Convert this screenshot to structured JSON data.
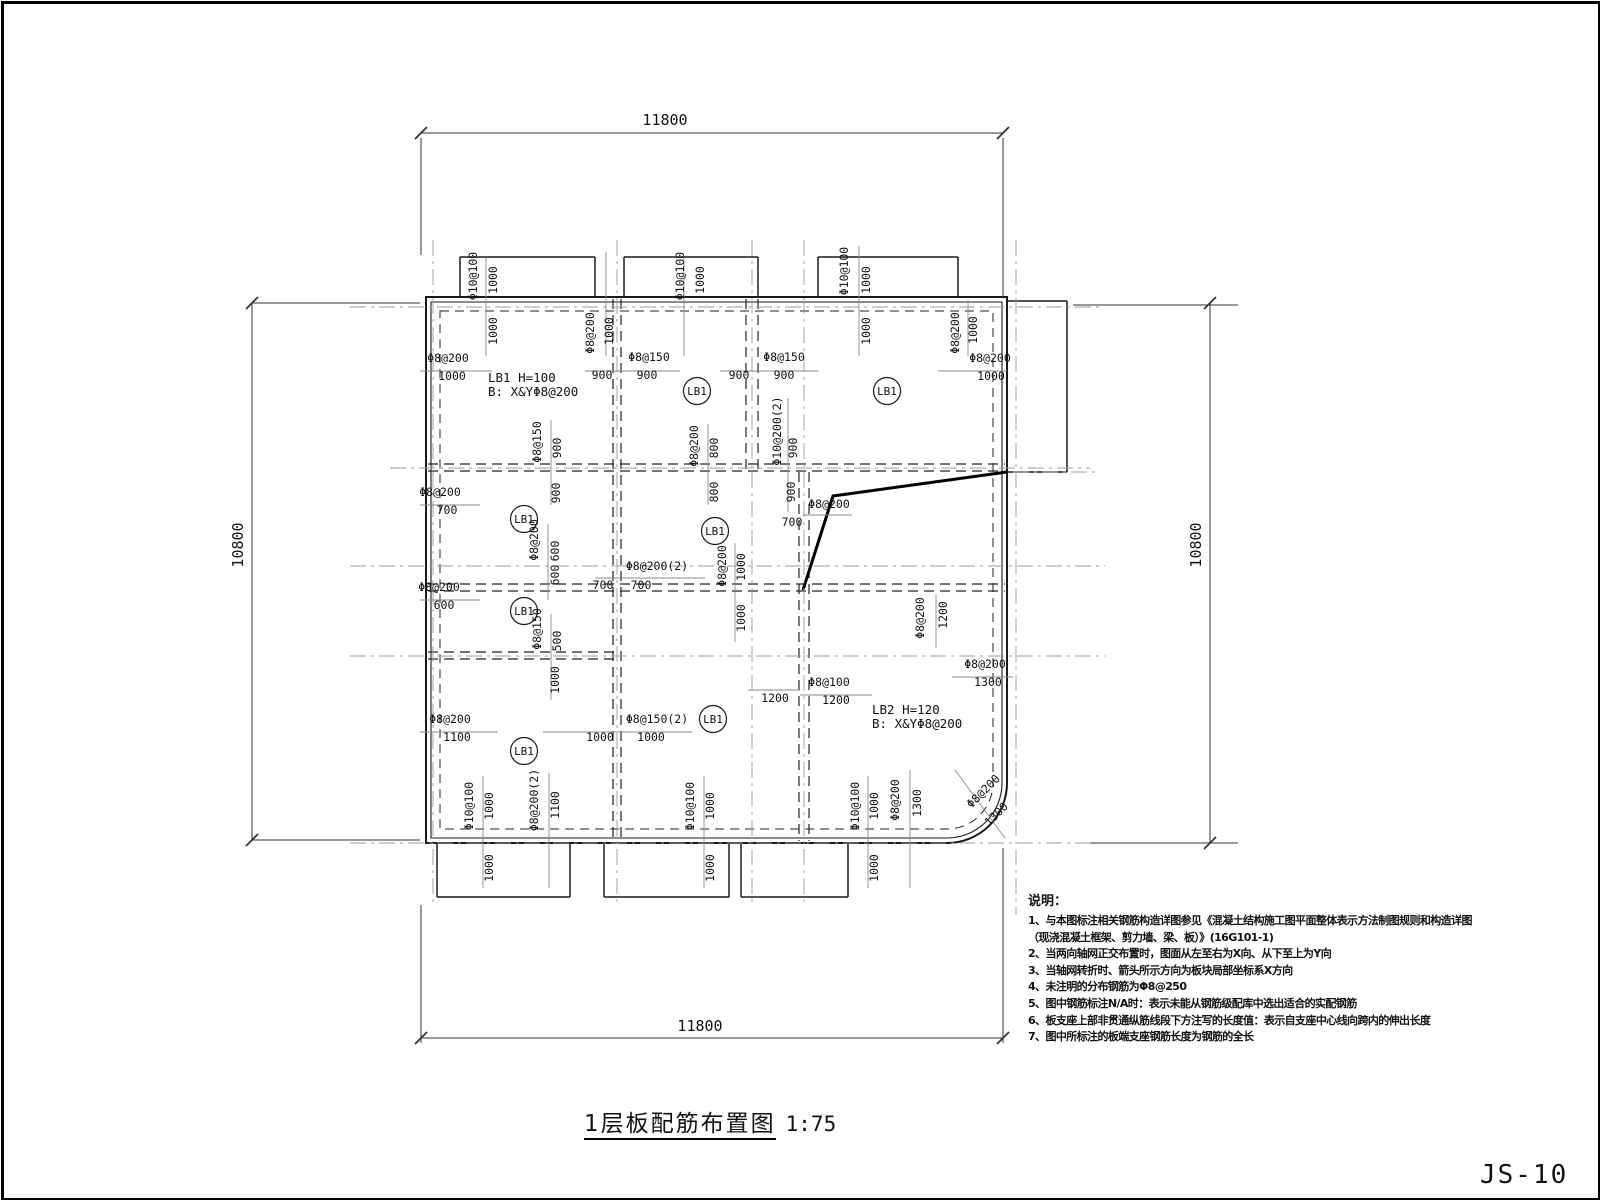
{
  "sheet": {
    "number": "JS-10"
  },
  "title_block": {
    "title": "1层板配筋布置图",
    "scale": "1:75"
  },
  "notes": {
    "heading": "说明：",
    "lines": [
      "1、与本图标注相关钢筋构造详图参见《混凝土结构施工图平面整体表示方法制图规则和构造详图",
      "（现浇混凝土框架、剪力墙、梁、板）》(16G101-1)",
      "2、当两向轴网正交布置时，图面从左至右为X向、从下至上为Y向",
      "3、当轴网转折时、箭头所示方向为板块局部坐标系X方向",
      "4、未注明的分布钢筋为Φ8@250",
      "5、图中钢筋标注N/A时：表示未能从钢筋级配库中选出适合的实配钢筋",
      "6、板支座上部非贯通纵筋线段下方注写的长度值：表示自支座中心线向跨内的伸出长度",
      "7、图中所标注的板端支座钢筋长度为钢筋的全长"
    ]
  },
  "plan": {
    "dimensions": [
      {
        "t": "11800",
        "x": 665,
        "y": 125,
        "o": "h"
      },
      {
        "t": "11800",
        "x": 700,
        "y": 1031,
        "o": "h"
      },
      {
        "t": "10800",
        "x": 243,
        "y": 545,
        "o": "v"
      },
      {
        "t": "10800",
        "x": 1201,
        "y": 545,
        "o": "v"
      }
    ],
    "panel_specs": [
      {
        "line1": "LB1 H=100",
        "line2": "B: X&YΦ8@200",
        "x": 488,
        "y": 382
      },
      {
        "line1": "LB2 H=120",
        "line2": "B: X&YΦ8@200",
        "x": 872,
        "y": 714
      }
    ],
    "panel_tags": [
      {
        "label": "LB1",
        "x": 697,
        "y": 391
      },
      {
        "label": "LB1",
        "x": 887,
        "y": 391
      },
      {
        "label": "LB1",
        "x": 524,
        "y": 519
      },
      {
        "label": "LB1",
        "x": 715,
        "y": 531
      },
      {
        "label": "LB1",
        "x": 524,
        "y": 611
      },
      {
        "label": "LB1",
        "x": 524,
        "y": 751
      },
      {
        "label": "LB1",
        "x": 713,
        "y": 719
      }
    ],
    "rebar_labels": [
      {
        "t": "Φ10@100",
        "x": 477,
        "y": 276,
        "o": "v"
      },
      {
        "t": "1000",
        "x": 497,
        "y": 280,
        "o": "v"
      },
      {
        "t": "Φ10@100",
        "x": 684,
        "y": 276,
        "o": "v"
      },
      {
        "t": "1000",
        "x": 704,
        "y": 280,
        "o": "v"
      },
      {
        "t": "Φ10@100",
        "x": 848,
        "y": 271,
        "o": "v"
      },
      {
        "t": "1000",
        "x": 870,
        "y": 280,
        "o": "v"
      },
      {
        "t": "1000",
        "x": 497,
        "y": 331,
        "o": "v"
      },
      {
        "t": "Φ8@200",
        "x": 594,
        "y": 333,
        "o": "v"
      },
      {
        "t": "1000",
        "x": 613,
        "y": 331,
        "o": "v"
      },
      {
        "t": "1000",
        "x": 870,
        "y": 331,
        "o": "v"
      },
      {
        "t": "Φ8@200",
        "x": 959,
        "y": 333,
        "o": "v"
      },
      {
        "t": "1000",
        "x": 977,
        "y": 330,
        "o": "v"
      },
      {
        "t": "Φ8@200",
        "x": 448,
        "y": 362,
        "o": "h"
      },
      {
        "t": "1000",
        "x": 452,
        "y": 380,
        "o": "h"
      },
      {
        "t": "900",
        "x": 602,
        "y": 379,
        "o": "h"
      },
      {
        "t": "Φ8@150",
        "x": 649,
        "y": 361,
        "o": "h"
      },
      {
        "t": "900",
        "x": 647,
        "y": 379,
        "o": "h"
      },
      {
        "t": "900",
        "x": 739,
        "y": 379,
        "o": "h"
      },
      {
        "t": "Φ8@150",
        "x": 784,
        "y": 361,
        "o": "h"
      },
      {
        "t": "900",
        "x": 784,
        "y": 379,
        "o": "h"
      },
      {
        "t": "Φ8@200",
        "x": 990,
        "y": 362,
        "o": "h"
      },
      {
        "t": "1000",
        "x": 991,
        "y": 380,
        "o": "h"
      },
      {
        "t": "Φ8@150",
        "x": 541,
        "y": 442,
        "o": "v"
      },
      {
        "t": "900",
        "x": 561,
        "y": 448,
        "o": "v"
      },
      {
        "t": "Φ8@200",
        "x": 698,
        "y": 446,
        "o": "v"
      },
      {
        "t": "800",
        "x": 718,
        "y": 448,
        "o": "v"
      },
      {
        "t": "Φ10@200(2)",
        "x": 781,
        "y": 431,
        "o": "v"
      },
      {
        "t": "900",
        "x": 797,
        "y": 448,
        "o": "v"
      },
      {
        "t": "800",
        "x": 718,
        "y": 492,
        "o": "v"
      },
      {
        "t": "900",
        "x": 795,
        "y": 492,
        "o": "v"
      },
      {
        "t": "900",
        "x": 560,
        "y": 493,
        "o": "v"
      },
      {
        "t": "Φ8@200",
        "x": 440,
        "y": 496,
        "o": "h"
      },
      {
        "t": "700",
        "x": 447,
        "y": 514,
        "o": "h"
      },
      {
        "t": "Φ8@200",
        "x": 829,
        "y": 508,
        "o": "h"
      },
      {
        "t": "700",
        "x": 792,
        "y": 526,
        "o": "h"
      },
      {
        "t": "Φ8@200",
        "x": 726,
        "y": 566,
        "o": "v"
      },
      {
        "t": "1000",
        "x": 745,
        "y": 567,
        "o": "v"
      },
      {
        "t": "1000",
        "x": 745,
        "y": 618,
        "o": "v"
      },
      {
        "t": "Φ8@200",
        "x": 538,
        "y": 540,
        "o": "v"
      },
      {
        "t": "600",
        "x": 559,
        "y": 551,
        "o": "v"
      },
      {
        "t": "600",
        "x": 559,
        "y": 575,
        "o": "v"
      },
      {
        "t": "Φ8@200(2)",
        "x": 657,
        "y": 570,
        "o": "h"
      },
      {
        "t": "700",
        "x": 603,
        "y": 589,
        "o": "h"
      },
      {
        "t": "700",
        "x": 641,
        "y": 589,
        "o": "h"
      },
      {
        "t": "Φ8@200",
        "x": 439,
        "y": 591,
        "o": "h"
      },
      {
        "t": "600",
        "x": 444,
        "y": 609,
        "o": "h"
      },
      {
        "t": "Φ8@150",
        "x": 541,
        "y": 629,
        "o": "v"
      },
      {
        "t": "500",
        "x": 561,
        "y": 641,
        "o": "v"
      },
      {
        "t": "1000",
        "x": 559,
        "y": 680,
        "o": "v"
      },
      {
        "t": "Φ8@200",
        "x": 924,
        "y": 618,
        "o": "v"
      },
      {
        "t": "1200",
        "x": 947,
        "y": 615,
        "o": "v"
      },
      {
        "t": "Φ8@200",
        "x": 985,
        "y": 668,
        "o": "h"
      },
      {
        "t": "1300",
        "x": 988,
        "y": 686,
        "o": "h"
      },
      {
        "t": "Φ8@100",
        "x": 829,
        "y": 686,
        "o": "h"
      },
      {
        "t": "1200",
        "x": 836,
        "y": 704,
        "o": "h"
      },
      {
        "t": "1200",
        "x": 775,
        "y": 702,
        "o": "h"
      },
      {
        "t": "Φ8@200",
        "x": 450,
        "y": 723,
        "o": "h"
      },
      {
        "t": "1100",
        "x": 457,
        "y": 741,
        "o": "h"
      },
      {
        "t": "1000",
        "x": 600,
        "y": 741,
        "o": "h"
      },
      {
        "t": "Φ8@150(2)",
        "x": 657,
        "y": 723,
        "o": "h"
      },
      {
        "t": "1000",
        "x": 651,
        "y": 741,
        "o": "h"
      },
      {
        "t": "Φ10@100",
        "x": 473,
        "y": 806,
        "o": "v"
      },
      {
        "t": "1000",
        "x": 493,
        "y": 806,
        "o": "v"
      },
      {
        "t": "Φ8@200(2)",
        "x": 538,
        "y": 800,
        "o": "v"
      },
      {
        "t": "1100",
        "x": 559,
        "y": 805,
        "o": "v"
      },
      {
        "t": "Φ10@100",
        "x": 694,
        "y": 806,
        "o": "v"
      },
      {
        "t": "1000",
        "x": 714,
        "y": 806,
        "o": "v"
      },
      {
        "t": "Φ10@100",
        "x": 859,
        "y": 806,
        "o": "v"
      },
      {
        "t": "1000",
        "x": 878,
        "y": 806,
        "o": "v"
      },
      {
        "t": "Φ8@200",
        "x": 899,
        "y": 800,
        "o": "v"
      },
      {
        "t": "1300",
        "x": 921,
        "y": 803,
        "o": "v"
      },
      {
        "t": "Φ8@200",
        "x": 986,
        "y": 794,
        "o": "d"
      },
      {
        "t": "1300",
        "x": 999,
        "y": 817,
        "o": "d"
      },
      {
        "t": "1000",
        "x": 493,
        "y": 868,
        "o": "v"
      },
      {
        "t": "1000",
        "x": 714,
        "y": 868,
        "o": "v"
      },
      {
        "t": "1000",
        "x": 878,
        "y": 868,
        "o": "v"
      }
    ]
  },
  "colors": {
    "line": "#1a1a1a",
    "beam": "#222222",
    "axis": "#9b9b9b",
    "leader": "#8a8a8a",
    "dim": "#333333",
    "text": "#111111",
    "bg": "#ffffff"
  }
}
